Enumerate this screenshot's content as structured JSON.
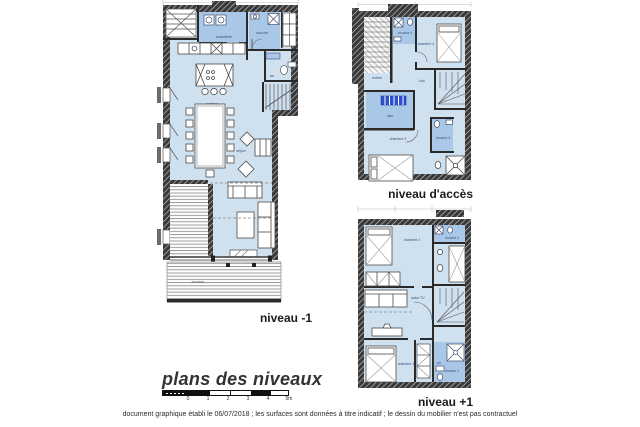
{
  "sheet": {
    "title": "plans des niveaux",
    "disclaimer": "document graphique établi le 06/07/2018 ; les surfaces sont données à titre indicatif ; le dessin du mobilier n'est pas contractuel",
    "scale_labels": [
      "0",
      "1",
      "2",
      "3",
      "4",
      "5m"
    ]
  },
  "colors": {
    "floor_blue": "#cfe0ef",
    "wet_room_blue": "#a9c7e6",
    "ski_rack_blue": "#2d4fd0",
    "wall_dark": "#2a2a2a"
  },
  "plans": {
    "minus1": {
      "caption": "niveau -1",
      "rooms": {
        "laundry": "buanderie",
        "shower": "douche",
        "wc": "wc",
        "kitchen": "cuisine",
        "living": "séjour",
        "terrace": "terrasse"
      }
    },
    "access": {
      "caption": "niveau d'accès",
      "rooms": {
        "entry": "entrée",
        "shower4": "douche 4",
        "bedroom4": "chambre 4",
        "hall": "hall",
        "ski": "skis",
        "bedroom3": "chambre 3",
        "shower3": "douche 3"
      }
    },
    "plus1": {
      "caption": "niveau +1",
      "rooms": {
        "bedroom2": "chambre 2",
        "shower2": "douche 2",
        "tv": "salon TV",
        "bedroom1": "chambre 1",
        "shower1": "douche 1",
        "wc": "wc"
      }
    }
  }
}
